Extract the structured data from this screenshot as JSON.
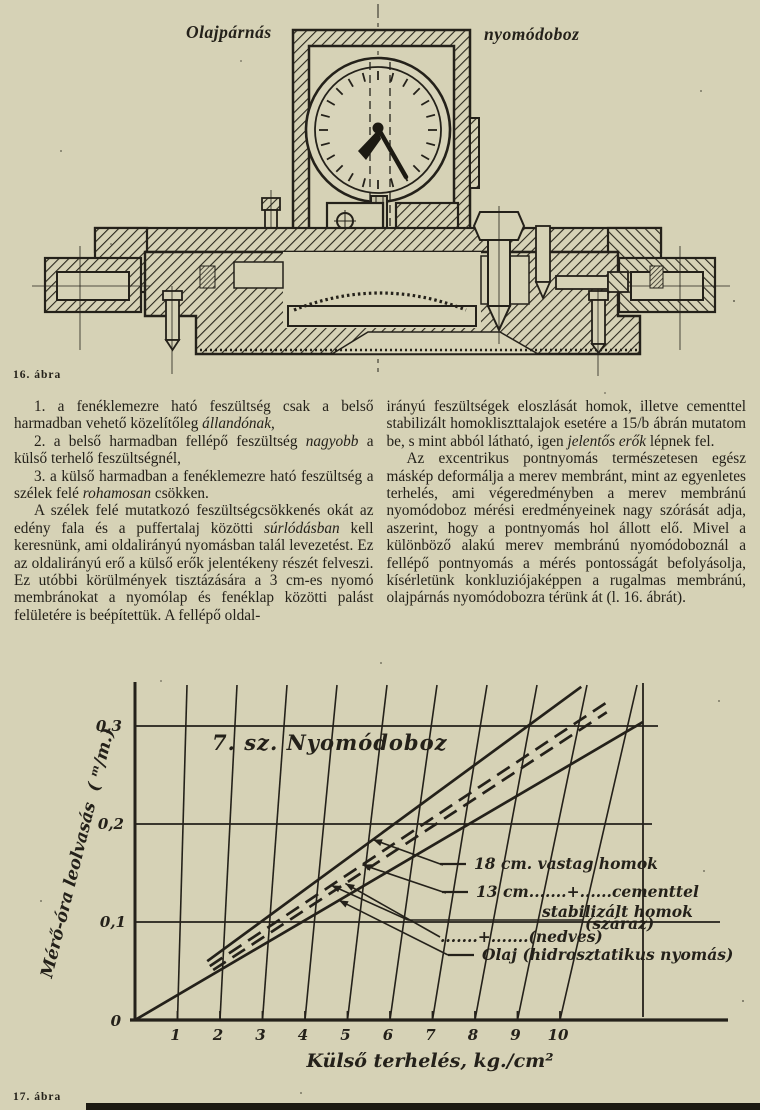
{
  "page": {
    "bg": "#d6d2b6",
    "ink": "#24211a"
  },
  "figure16": {
    "label_left": "Olajpárnás",
    "label_right": "nyomódoboz",
    "caption": "16. ábra"
  },
  "article": {
    "left_column": [
      "1. a fenéklemezre ható feszültség csak a belső harmadban vehető közelítőleg *állandónak*,",
      "2. a belső harmadban fellépő feszültség *nagyobb* a külső terhelő feszültségnél,",
      "3. a külső harmadban a fenéklemezre ható feszültség a szélek felé *rohamosan* csökken.",
      "A szélek felé mutatkozó feszültségcsökkenés okát az edény fala és a puffertalaj közötti *súrlódásban* kell keresnünk, ami oldalirányú nyomásban talál levezetést. Ez az oldalirányú erő a külső erők jelentékeny részét felveszi. Ez utóbbi körülmények tisztázására a 3 cm-es nyomó membránokat a nyomólap és fenéklap közötti palást felületére is beépítettük. A fellépő oldal-"
    ],
    "right_column": [
      "irányú feszültségek eloszlását homok, illetve cementtel stabilizált homokliszttalajok esetére a 15/b ábrán mutatom be, s mint abból látható, igen *jelentős erők* lépnek fel.",
      "Az excentrikus pontnyomás természetesen egész máskép deformálja a merev membránt, mint az egyenletes terhelés, ami végeredményben a merev membránú nyomódoboz mérési eredményeinek nagy szórását adja, aszerint, hogy a pontnyomás hol állott elő. Mivel a különböző alakú merev membránú nyomódoboznál a fellépő pontnyomás a mérés pontosságát befolyásolja, kísérletünk konkluziójaképpen a rugalmas membránú, olajpárnás nyomódobozra térünk át (l. 16. ábrát)."
    ]
  },
  "figure17": {
    "caption": "17. ábra"
  },
  "chart_data": {
    "type": "line",
    "title": "7. sz.  Nyomódoboz",
    "xlabel": "Külső terhelés,  kg./cm²",
    "ylabel": "Mérő-óra leolvasás",
    "ylabel_unit": "( ᵐ/m.)",
    "xlim": [
      0,
      12.2
    ],
    "ylim": [
      0,
      0.345
    ],
    "x_ticks": [
      1,
      2,
      3,
      4,
      5,
      6,
      7,
      8,
      9,
      10
    ],
    "x_tick_labels": [
      "1",
      "2",
      "3",
      "4",
      "5",
      "6",
      "7",
      "8",
      "9",
      "10"
    ],
    "y_ticks": [
      0,
      0.1,
      0.2,
      0.3
    ],
    "y_tick_labels": [
      "0",
      "0,1",
      "0,2",
      "0,3"
    ],
    "grid": true,
    "series": [
      {
        "name": "18 cm. vastag homok",
        "style": "solid",
        "points": [
          [
            1.7,
            0.06
          ],
          [
            10.5,
            0.34
          ]
        ]
      },
      {
        "name": "13 cm. + cementtel stabilizált homok (száraz)",
        "style": "dashed",
        "points": [
          [
            1.76,
            0.055
          ],
          [
            11.2,
            0.327
          ]
        ]
      },
      {
        "name": "13 cm. + cementtel stabilizált homok (nedves)",
        "style": "dashed",
        "points": [
          [
            1.84,
            0.051
          ],
          [
            11.1,
            0.314
          ]
        ]
      },
      {
        "name": "Olaj (hidrosztatikus nyomás)",
        "style": "solid",
        "points": [
          [
            0,
            0
          ],
          [
            11.95,
            0.304
          ]
        ]
      }
    ],
    "legend": {
      "position": "right-middle",
      "rows": [
        {
          "text": "18 cm. vastag homok",
          "marker": "solid"
        },
        {
          "text": "13 cm.......+......cementtel",
          "marker": "solid"
        },
        {
          "text": "stabilizált homok",
          "marker": "none"
        },
        {
          "text": "(száraz)",
          "marker": "none"
        },
        {
          "text": ".......+.......(nedves)",
          "marker": "none"
        },
        {
          "text": "Olaj  (hidrosztatikus nyomás)",
          "marker": "solid"
        }
      ]
    },
    "callouts": [
      5.6,
      5.35,
      4.95,
      4.8
    ]
  }
}
